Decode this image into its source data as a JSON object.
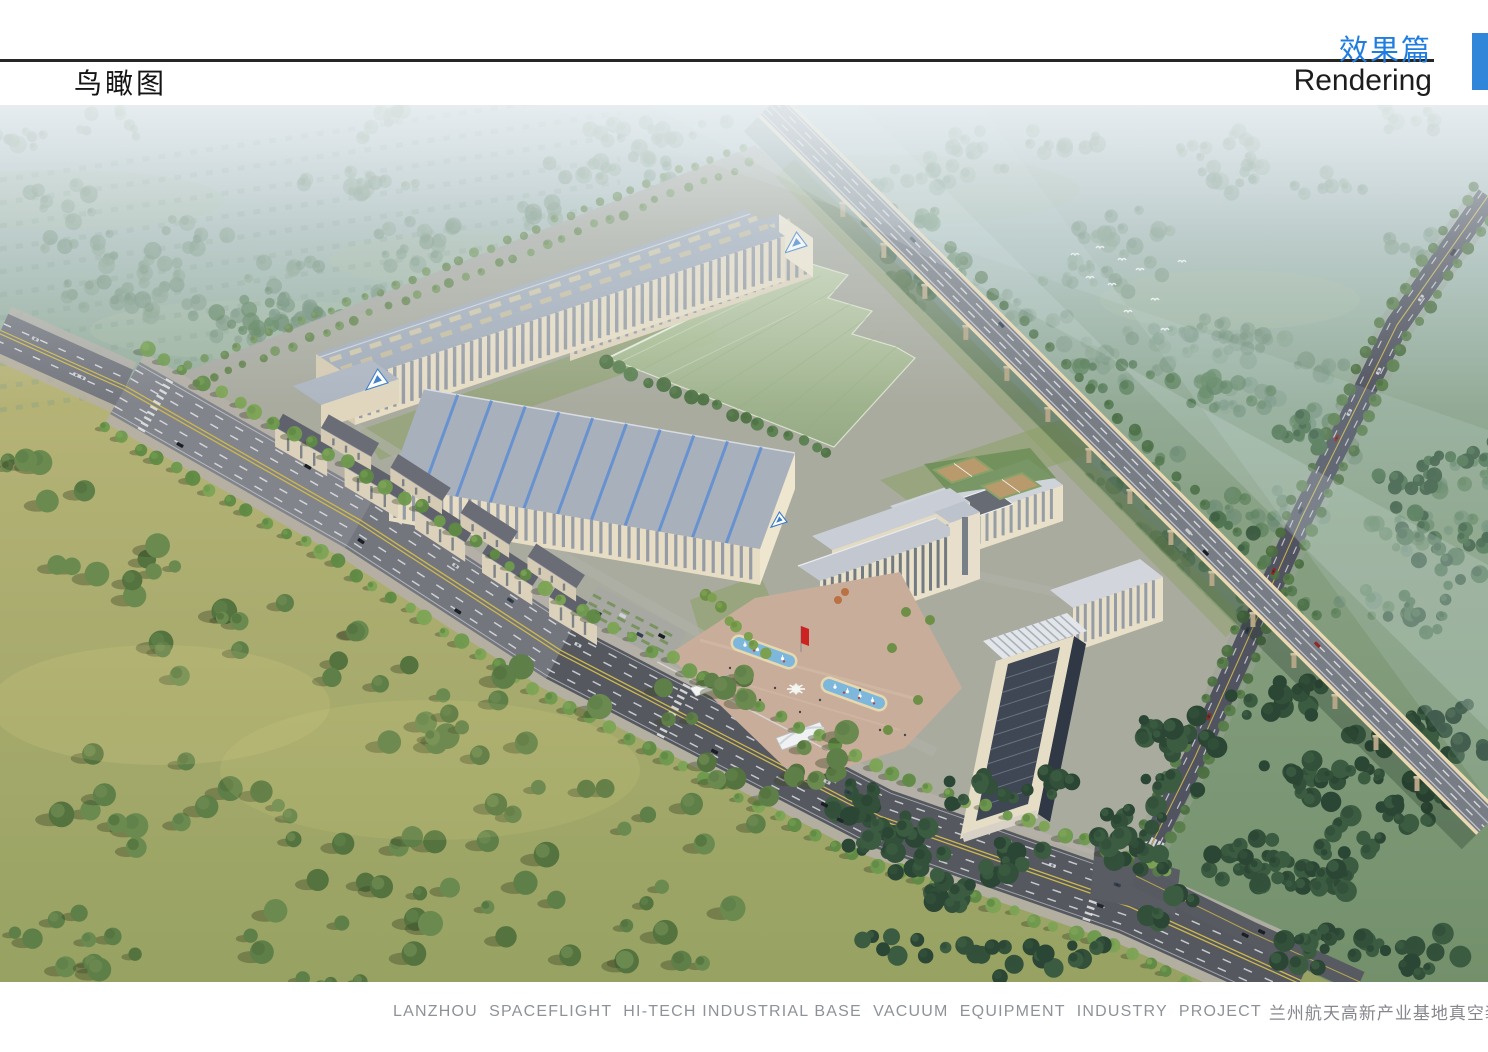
{
  "page": {
    "width": 1488,
    "height": 1052,
    "background": "#ffffff"
  },
  "header": {
    "section_title": "鸟瞰图",
    "chapter_title_cn": "效果篇",
    "chapter_title_en": "Rendering",
    "accent_color": "#1f7de0",
    "rule_color": "#262626",
    "corner_block_color": "#3087d9"
  },
  "footer": {
    "caption_en": "LANZHOU  SPACEFLIGHT  HI-TECH INDUSTRIAL BASE  VACUUM  EQUIPMENT  INDUSTRY  PROJECT",
    "caption_cn": "兰州航天高新产业基地真空装备产业园项目",
    "caption_color": "#8e9399",
    "marker_color": "#3087d9"
  },
  "scene": {
    "palette": {
      "sky_top": "#bcc9d0",
      "sky_mid": "#9db4a8",
      "ground_mid": "#87a082",
      "ground_low": "#73906b",
      "meadow_hi": "#b8b478",
      "meadow_lo": "#97a262",
      "forest_haze1": "#7c9884",
      "forest_haze2": "#6f8d77",
      "forest_haze3": "#86a18c",
      "forest_mid1": "#5a8059",
      "forest_mid2": "#4f7450",
      "forest_dark1": "#32503a",
      "forest_dark2": "#3c5c42",
      "forest_dark3": "#2b4634",
      "tree_bright1": "#6f9a4e",
      "tree_bright2": "#5f8a44",
      "tree_bright3": "#7da455",
      "tree_shadow": "rgba(58,68,38,0.38)",
      "road_asphalt": "#74767e",
      "road_dark": "#515460",
      "lane_white": "#eceff0",
      "lane_yellow": "#cdb84e",
      "sidewalk": "#b5afa9",
      "campus_ground": "#a9ab9f",
      "grass": "#8ba064",
      "bld_cream": "#e7ddc5",
      "bld_cream_lt": "#efe6d0",
      "bld_cream_sh": "#d6cbb3",
      "roof_bluegray": "#a3adba",
      "roof_light": "#cfd3da",
      "roof_dark": "#5f626c",
      "skylight_tan": "#cfc7a9",
      "glass_dark": "#3e4753",
      "window_strip": "#87919f",
      "stripe_blue": "#5f8fd0",
      "logo_blue": "#3a7cc8",
      "green_zone": "#a8be96",
      "green_zone_edge": "#dfe8d0",
      "water_blue": "#7db8dc",
      "pool_rim": "#e7d8ae",
      "plaza": "#c9ad9b",
      "highway_deck": "#787c84",
      "highway_edge": "#ead9b2",
      "pier_tan": "#b3a585",
      "flag_red": "#cc2222",
      "bird_white": "#f5f8fa"
    }
  }
}
